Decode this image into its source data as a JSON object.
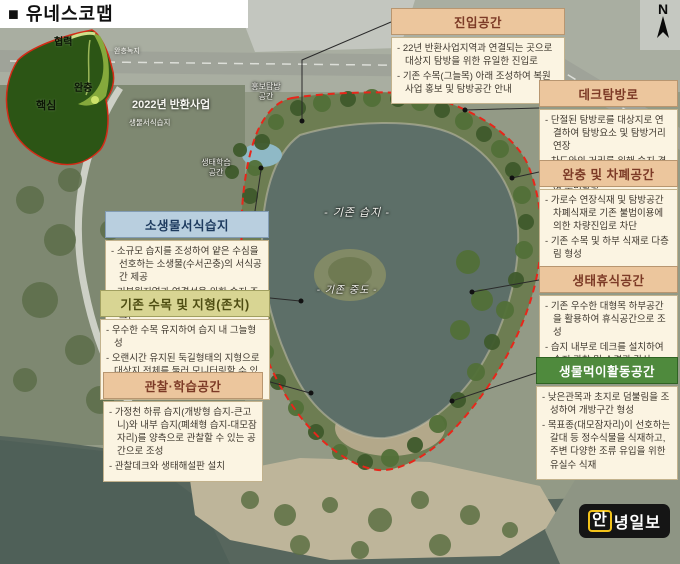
{
  "title": "■ 유네스코맵",
  "compass_label": "N",
  "watermark": {
    "first": "안",
    "rest": "녕일보"
  },
  "colors": {
    "header_peach": "#ecc69d",
    "header_blue": "#b9cfdf",
    "header_olive": "#d8d593",
    "header_green": "#4f8a3d",
    "boundary_red": "#e8261a",
    "logo_yellow": "#f2c21a"
  },
  "unesco_inset": {
    "zone_coop": "협력",
    "zone_buffer": "완충",
    "zone_core": "핵심",
    "label_buffer_green": "완충녹지",
    "label_project": "2022년 반환사업",
    "label_habitat": "생물서식습지"
  },
  "map_labels": {
    "eco_learning": "생태학습\n공간",
    "promo_tour": "홍보탐방\n공간",
    "existing_wetland": "- 기존 습지 -",
    "existing_island": "- 기존 중도 -"
  },
  "boxes": [
    {
      "title": "진입공간",
      "bullets": [
        "22년 반환사업지역과 연결되는 곳으로 대상지 탐방을 위한 유일한 진입로",
        "기존 수목(그늘목) 아래 조성하여 복원사업 홍보 및 탐방공간 안내"
      ]
    },
    {
      "title": "데크탐방로",
      "bullets": [
        "단절된 탐방로를 대상지로 연결하여 탐방요소 및 탐방거리 연장",
        "차도와의 거리를 위해 습지 경계로 최소한의 데크를 설치하여 수변탐방"
      ]
    },
    {
      "title": "완충 및 차폐공간",
      "bullets": [
        "가로수 연장식재 및 탐방공간 차폐식재로 기존 불법이용에 의한 차량진입로 차단",
        "기존 수목 및 하부 식재로 다층림 형성"
      ]
    },
    {
      "title": "생태휴식공간",
      "bullets": [
        "기존 우수한 대형목 하부공간을 활용하여 휴식공간으로 조성",
        "습지 내부로 데크를 설치하여 습지 관찰 및 수경관 감상"
      ]
    },
    {
      "title": "생물먹이활동공간",
      "bullets": [
        "낮은관목과 초지로 덤불림을 조성하여 개방구간 형성",
        "목표종(대모잠자리)이 선호하는 갈대 등 정수식물을 식재하고, 주변 다양한 조류 유입을 위한 유실수 식재"
      ]
    },
    {
      "title": "소생물서식습지",
      "bullets": [
        "소규모 습지를 조성하여 얕은 수심을 선호하는 소생물(수서곤충)의 서식공간 제공",
        "기복원지역과 연결성을 위한 습지 조성 (추후 생물서식습지로의 수원 공급)"
      ]
    },
    {
      "title": "기존 수목 및 지형(존치)",
      "bullets": [
        "우수한 수목 유지하여 습지 내 그늘형성",
        "오랜시간 유지된 둑길형태의 지형으로 대상지 전체를 둘러 모니터링할 수 있는 동선으로 활용(탐방객 진입 억제)"
      ]
    },
    {
      "title": "관찰·학습공간",
      "bullets": [
        "가정천 하류 습지(개방형 습지-큰고니)와 내부 습지(폐쇄형 습지-대모잠자리)를 양측으로 관찰할 수 있는 공간으로 조성",
        "관찰데크와 생태해설판 설치"
      ]
    }
  ]
}
